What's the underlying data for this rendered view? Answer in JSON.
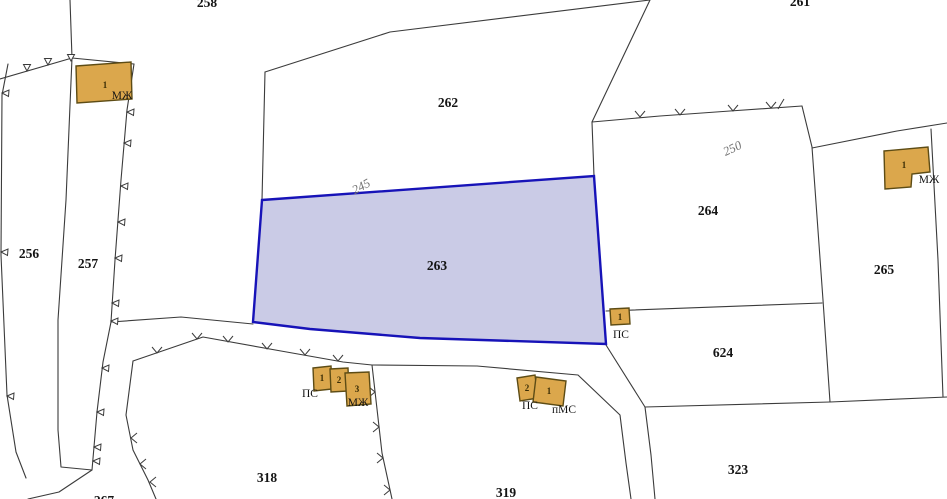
{
  "map": {
    "type": "cadastral-parcel-map",
    "selected_parcel": "263",
    "colors": {
      "background": "#ffffff",
      "boundary_line": "#3b3b3b",
      "selected_fill": "#cacbe6",
      "selected_stroke": "#1713b8",
      "building_fill": "#dba74c",
      "building_stroke": "#5d4c15",
      "parcel_label": "#141414",
      "building_number": "#3a2d05",
      "contour_label": "#6f6f6f"
    },
    "parcel_labels": {
      "256": "256",
      "257": "257",
      "262": "262",
      "263": "263",
      "264": "264",
      "265": "265",
      "318": "318",
      "319": "319",
      "323": "323",
      "624": "624"
    },
    "partial_parcel_labels": {
      "top_center": "258",
      "top_right": "261",
      "bottom_left": "267"
    },
    "contour_labels": {
      "c245": "245",
      "c250": "250"
    },
    "buildings": {
      "left_mzh": {
        "num": "1",
        "type": "МЖ"
      },
      "right_mzh": {
        "num": "1",
        "type": "МЖ"
      },
      "ps_263": {
        "num": "1",
        "type": "ПС"
      },
      "cluster_318": {
        "b1": "1",
        "b2": "2",
        "b3": "3",
        "type_left": "ПС",
        "type_right": "МЖ"
      },
      "cluster_319": {
        "b2": "2",
        "b1": "1",
        "type_left": "ПС",
        "type_right": "пМС"
      }
    }
  }
}
